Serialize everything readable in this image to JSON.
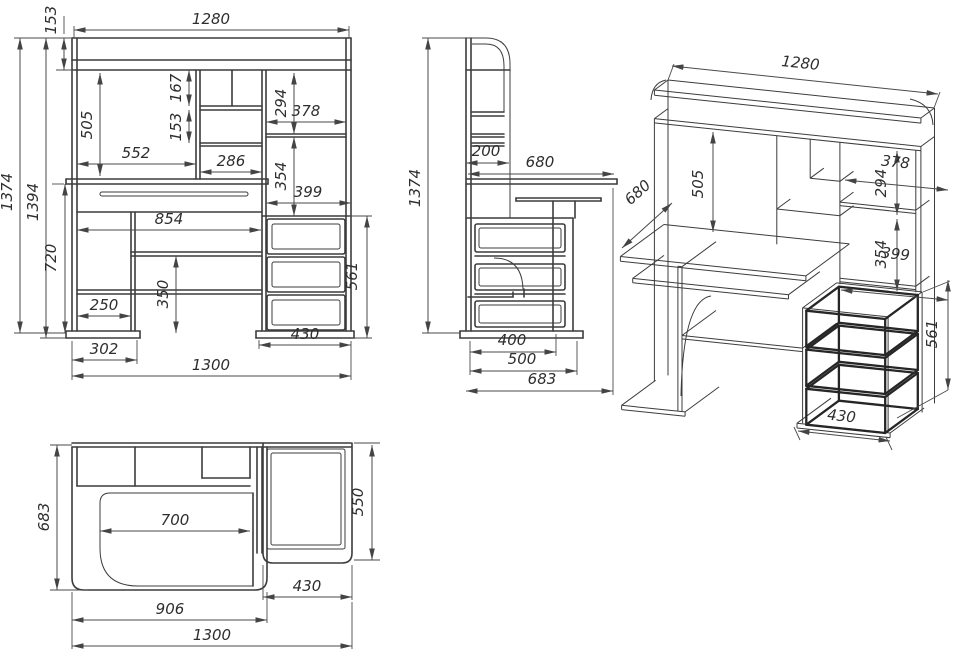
{
  "colors": {
    "line": "#3c3c3c",
    "dimension": "#4a4a4a",
    "background": "#ffffff"
  },
  "dims": {
    "front": {
      "width_top": "1280",
      "top_shelf_h": "153",
      "height_total": "1374",
      "height_overall": "1394",
      "hutch_h": "505",
      "cubby_gap_1": "167",
      "cubby_gap_2": "153",
      "opening_w": "552",
      "cubby_w": "286",
      "side_gap_1": "294",
      "side_w": "378",
      "side_gap_2": "354",
      "side_w_2": "399",
      "drawer_front_w": "854",
      "desk_h": "720",
      "under_shelf_h": "350",
      "knee_opening_w": "250",
      "left_plinth_w": "302",
      "pedestal_w": "430",
      "base_w": "1300",
      "pedestal_h": "561"
    },
    "side": {
      "height_total": "1374",
      "back_depth": "200",
      "desktop_depth": "680",
      "drawer_depth": "400",
      "pedestal_depth": "500",
      "total_depth": "683"
    },
    "iso": {
      "width_top": "1280",
      "hutch_h": "505",
      "side_gap_1": "294",
      "side_w": "378",
      "desktop_depth": "680",
      "side_gap_2": "354",
      "side_w_2": "399",
      "pedestal_h": "561",
      "pedestal_w": "430"
    },
    "plan": {
      "total_depth": "683",
      "tray_w": "700",
      "pedestal_depth": "550",
      "pedestal_w": "430",
      "desktop_w": "906",
      "base_w": "1300"
    }
  }
}
